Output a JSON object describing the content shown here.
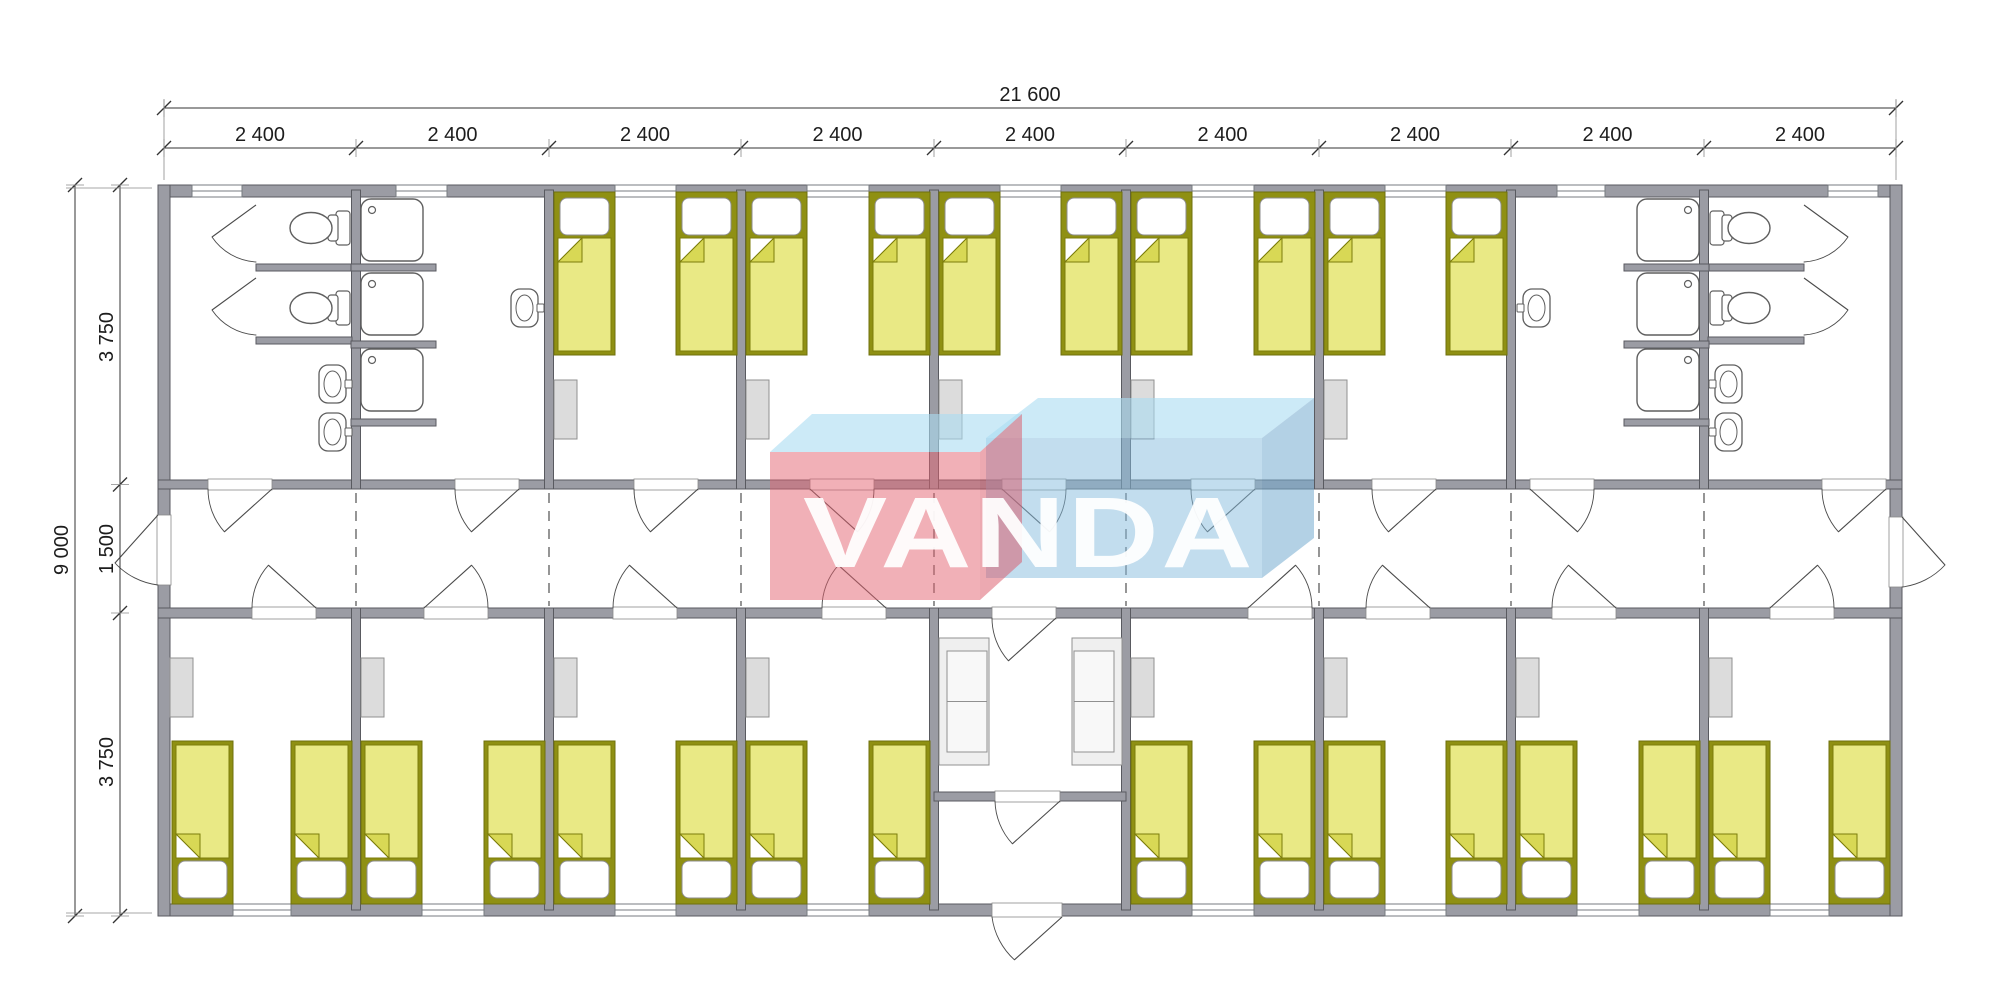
{
  "title": "VANDA modular dormitory floor plan",
  "watermark": {
    "text": "VANDA"
  },
  "dimensions": {
    "overall_width": "21 600",
    "module_width": "2 400",
    "module_count": 9,
    "overall_height": "9 000",
    "top_room_depth": "3 750",
    "corridor_width": "1 500",
    "bottom_room_depth": "3 750"
  },
  "inventory": {
    "modules": 9,
    "bedrooms": 13,
    "beds": 26,
    "wardrobes": 13,
    "sofas": 2,
    "shower_stalls": 6,
    "toilets": 4,
    "wash_basins": 6,
    "windows": 17,
    "exterior_doors": 3,
    "interior_doors": 23
  },
  "colors": {
    "wall": "#9b9ca4",
    "wall_outline": "#595a60",
    "line": "#4a4a4a",
    "dim_text": "#1d1d1d",
    "ext_line": "#8a8a8a",
    "bed_mattress": "#e9e985",
    "bed_frame": "#8f9013",
    "bed_frame_dark": "#6f700c",
    "bed_fold": "#d8d855",
    "pillow": "#ffffff",
    "furniture_fill": "#dcdcdc",
    "furniture_outline": "#909090",
    "sofa_fill": "#efefef",
    "sofa_seat": "#f8f8f8",
    "fixture_fill": "#ffffff",
    "fixture_outline": "#5f5f5f",
    "module_line": "#4f4f4f",
    "watermark_red": "#e4626f",
    "watermark_red_side": "#d95463",
    "watermark_blue": "#85bcde",
    "watermark_blue_side": "#74abd0",
    "watermark_top": "#aadcf2",
    "watermark_text": "#ffffff"
  }
}
